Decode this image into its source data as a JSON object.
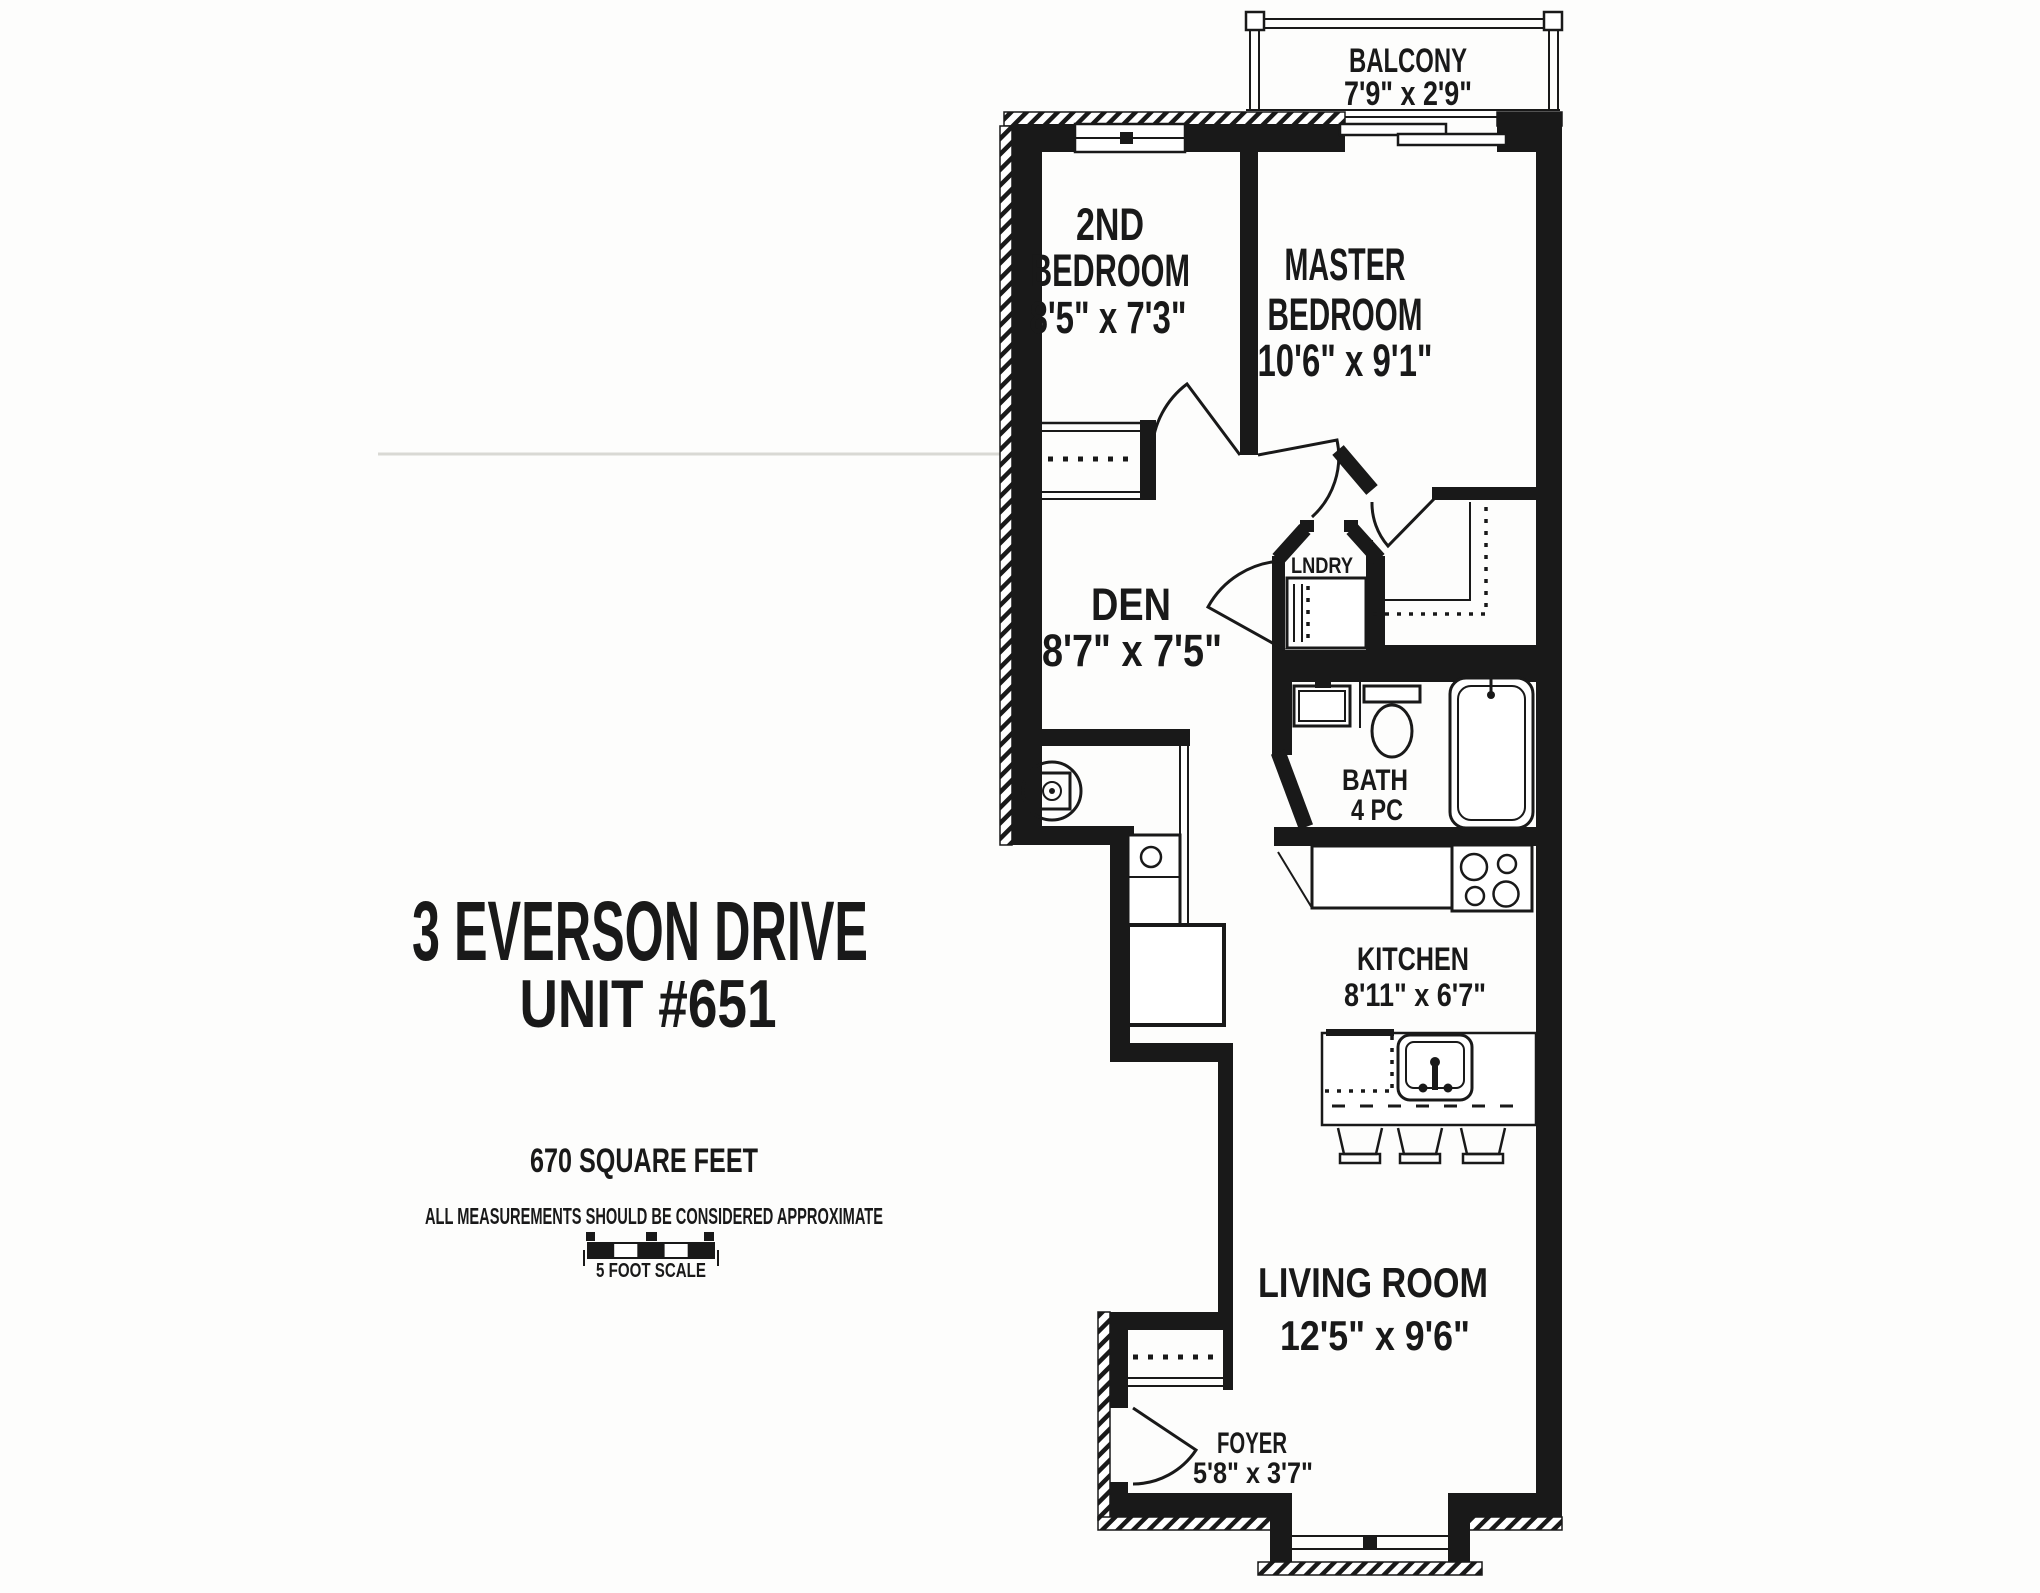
{
  "colors": {
    "ink": "#191919",
    "paper": "#ffffff",
    "page": "#fdfdfc",
    "faint": "#d9d9d4"
  },
  "title": {
    "line1": "3 EVERSON DRIVE",
    "line2": "UNIT #651"
  },
  "area_text": "670 SQUARE FEET",
  "disclaimer": "ALL MEASUREMENTS SHOULD BE CONSIDERED APPROXIMATE",
  "scale": {
    "label": "5 FOOT SCALE"
  },
  "rooms": {
    "balcony": {
      "name": "BALCONY",
      "dims": "7'9\" x 2'9\""
    },
    "bedroom2": {
      "name_line1": "2ND",
      "name_line2": "BEDROOM",
      "dims": "8'5\" x 7'3\""
    },
    "master": {
      "name_line1": "MASTER",
      "name_line2": "BEDROOM",
      "dims": "10'6\" x 9'1\""
    },
    "den": {
      "name": "DEN",
      "dims": "8'7\" x 7'5\""
    },
    "laundry": {
      "name": "LNDRY"
    },
    "bath": {
      "name": "BATH",
      "dims": "4 PC"
    },
    "kitchen": {
      "name": "KITCHEN",
      "dims": "8'11\" x 6'7\""
    },
    "living": {
      "name": "LIVING ROOM",
      "dims": "12'5\" x 9'6\""
    },
    "foyer": {
      "name": "FOYER",
      "dims": "5'8\" x 3'7\""
    }
  }
}
